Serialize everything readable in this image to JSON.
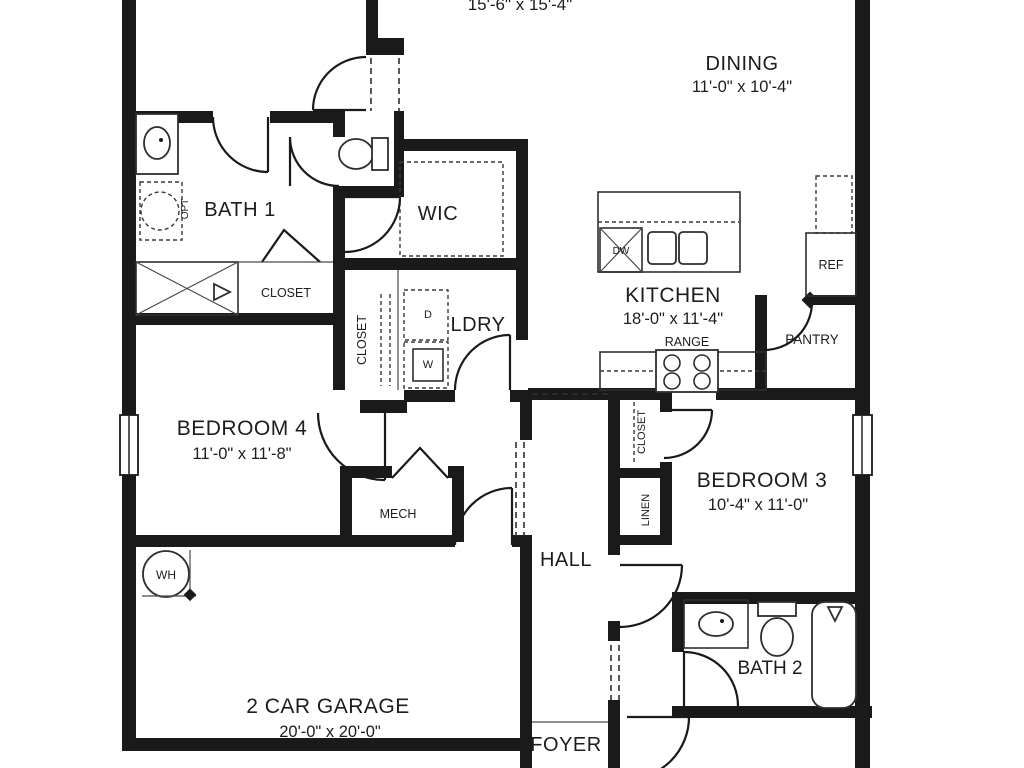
{
  "plan": {
    "title": "single-story floor plan",
    "colors": {
      "ink": "#1d1d1d",
      "paper": "#ffffff"
    },
    "rooms": {
      "great": {
        "dims_partial": "15'-6\" x 15'-4\""
      },
      "dining": {
        "name": "DINING",
        "dims": "11'-0\" x 10'-4\""
      },
      "bath1": {
        "name": "BATH 1"
      },
      "wic": {
        "name": "WIC"
      },
      "ldry": {
        "name": "LDRY"
      },
      "kitchen": {
        "name": "KITCHEN",
        "dims": "18'-0\" x 11'-4\""
      },
      "pantry": {
        "name": "PANTRY"
      },
      "bedroom4": {
        "name": "BEDROOM 4",
        "dims": "11'-0\" x 11'-8\""
      },
      "bedroom3": {
        "name": "BEDROOM 3",
        "dims": "10'-4\" x 11'-0\""
      },
      "mech": {
        "name": "MECH"
      },
      "hall": {
        "name": "HALL"
      },
      "bath2": {
        "name": "BATH 2"
      },
      "garage": {
        "name": "2 CAR GARAGE",
        "dims": "20'-0\" x 20'-0\""
      },
      "foyer": {
        "name": "FOYER"
      }
    },
    "closets": {
      "bath1_closet": "CLOSET",
      "ldry_closet": "CLOSET",
      "bed3_closet": "CLOSET",
      "linen": "LINEN"
    },
    "fixtures": {
      "range": "RANGE",
      "refrigerator": "REF",
      "dishwasher": "DW",
      "washer": "W",
      "dryer": "D",
      "water_heater": "WH",
      "optional_tub": "OPT"
    }
  }
}
